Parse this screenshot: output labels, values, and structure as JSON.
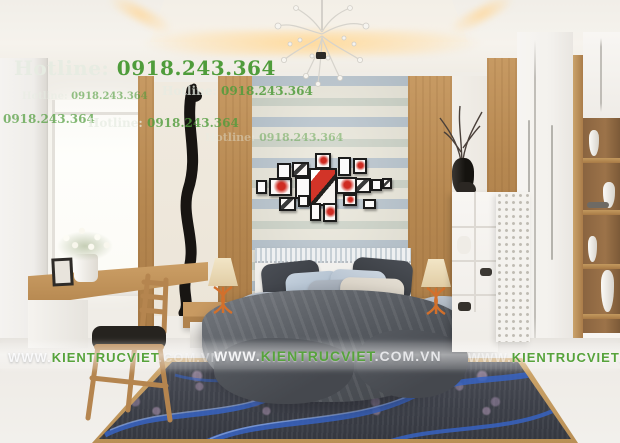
{
  "watermarks": {
    "hotline": {
      "label": "Hotline:",
      "number": "0918.243.364"
    },
    "website": {
      "www": "WWW.",
      "name": "KIENTRUCVIET",
      "tld": ".COM.VN"
    },
    "accent_green": "#4f9c3b"
  }
}
